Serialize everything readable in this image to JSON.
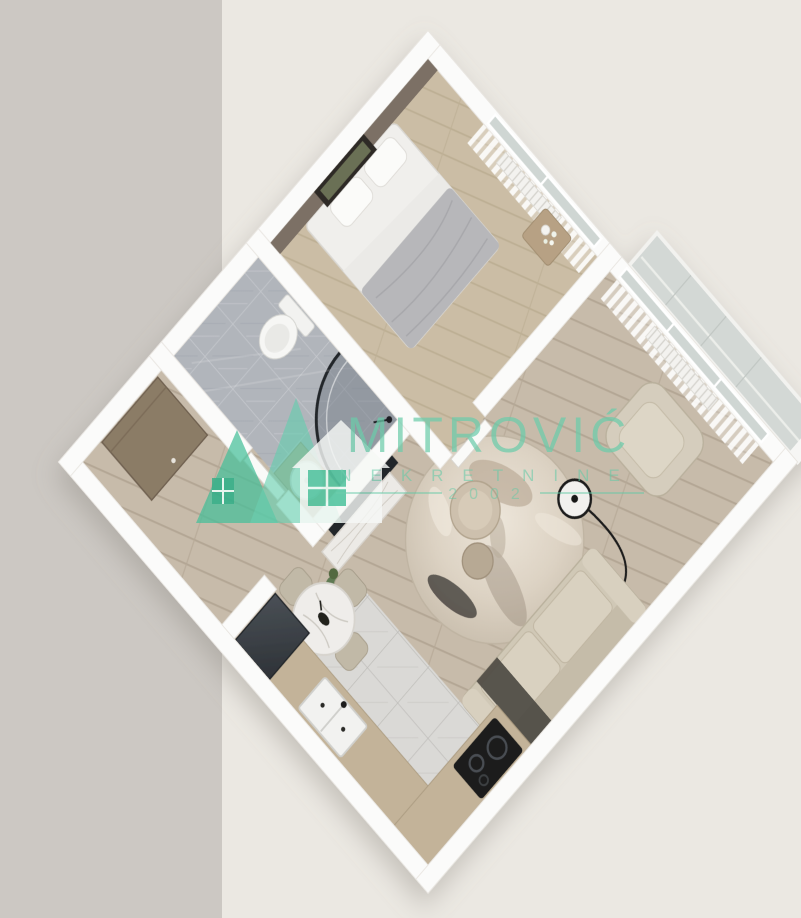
{
  "background": {
    "left_band_color": "#ccc8c3",
    "right_color": "#ebe8e2"
  },
  "watermark": {
    "brand": "MITROVIĆ",
    "subtitle": "NEKRETNINE",
    "year": "2002",
    "accent_color": "#5ac8a4",
    "logo": "double-house-real-estate-logo"
  },
  "floor_plan": {
    "type": "3d-apartment-floor-plan",
    "style": "top-down 3D render rotated 45 degrees, white walls",
    "rooms": [
      {
        "name": "bedroom",
        "features": [
          "double-bed",
          "gray-blanket",
          "pillows",
          "nightstand-with-flowers",
          "wall-art",
          "dark-accent-wall",
          "curtained-window",
          "radiator",
          "wood-floor"
        ]
      },
      {
        "name": "bathroom",
        "features": [
          "corner-shower-black-frame",
          "toilet",
          "round-basin-on-counter",
          "marble-tile-floor"
        ]
      },
      {
        "name": "hallway",
        "features": [
          "brown-entry-door",
          "wood-floor"
        ]
      },
      {
        "name": "living-room",
        "features": [
          "beige-sofa",
          "dark-throw",
          "beige-armchair",
          "arc-floor-lamp",
          "round-marbled-rug",
          "two-round-coffee-tables",
          "tv-partition-wall",
          "marble-tv-console",
          "green-plant",
          "round-marble-dining-table",
          "four-dining-chairs",
          "curtained-window",
          "radiator",
          "glass-balcony"
        ]
      },
      {
        "name": "kitchen",
        "features": [
          "l-shaped-wood-counter",
          "dark-fridge",
          "double-sink",
          "black-cooktop",
          "marble-tile-floor"
        ]
      }
    ],
    "palette": {
      "walls": "#fbfbfa",
      "living_wood_floor": "#c7bbaa",
      "bedroom_wood_floor": "#cbbda5",
      "bathroom_tile": "#b1b5bb",
      "kitchen_tile": "#dad9d6",
      "accent_wall": "#7b7065",
      "counter_wood": "#c3b399",
      "sofa_beige": "#d0c8b6",
      "fridge_dark": "#3b4046"
    }
  }
}
